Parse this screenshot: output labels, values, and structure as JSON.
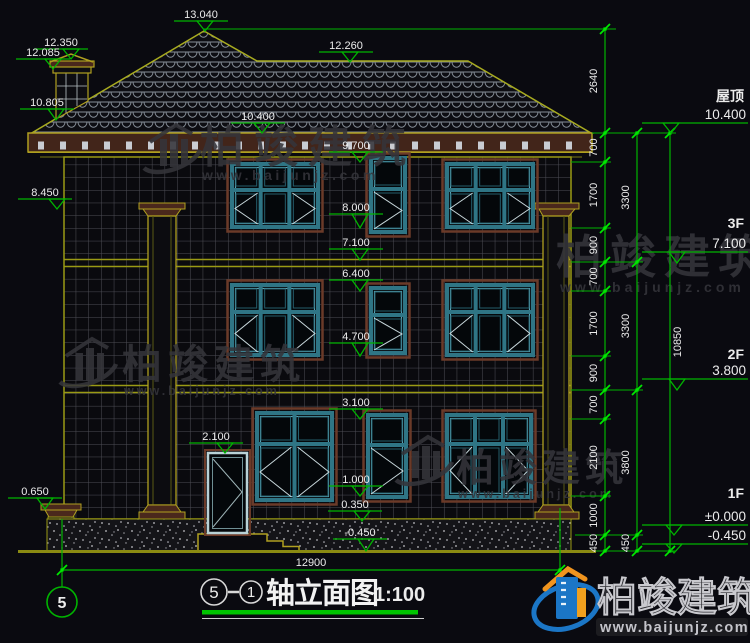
{
  "drawing": {
    "title": {
      "axis_start": "5",
      "axis_end": "1",
      "name": "轴立面图",
      "scale": "1:100"
    },
    "axis_bubble": {
      "label": "5"
    },
    "overall_width_dim": {
      "label": "12900",
      "y": 570,
      "x1": 62,
      "x2": 560,
      "lx": 311,
      "ly": 566
    },
    "levels_right": [
      {
        "name": "屋顶",
        "value": "10.400",
        "ny": 101,
        "vy": 119,
        "ly": 123,
        "ax": 671,
        "ay": 133
      },
      {
        "name": "3F",
        "value": "7.100",
        "ny": 228,
        "vy": 248,
        "ly": 252,
        "ax": 677,
        "ay": 263
      },
      {
        "name": "2F",
        "value": "3.800",
        "ny": 359,
        "vy": 375,
        "ly": 379,
        "ax": 677,
        "ay": 390
      },
      {
        "name": "1F",
        "value": "±0.000",
        "ny": 498,
        "vy": 521,
        "ly": 525,
        "ax": 674,
        "ay": 535
      },
      {
        "name": "",
        "value": "-0.450",
        "ny": 0,
        "vy": 540,
        "ly": 544,
        "ax": 674,
        "ay": 553
      }
    ],
    "levels_mid": [
      {
        "label": "13.040",
        "tx": 201,
        "ty": 18,
        "ax": 205,
        "ay": 31
      },
      {
        "label": "12.260",
        "tx": 346,
        "ty": 49,
        "ax": 350,
        "ay": 62
      },
      {
        "label": "10.400",
        "tx": 258,
        "ty": 120,
        "ax": 262,
        "ay": 133
      },
      {
        "label": "9.700",
        "tx": 356,
        "ty": 149,
        "ax": 360,
        "ay": 162
      },
      {
        "label": "8.000",
        "tx": 356,
        "ty": 211,
        "ax": 360,
        "ay": 228
      },
      {
        "label": "7.100",
        "tx": 356,
        "ty": 246,
        "ax": 360,
        "ay": 260
      },
      {
        "label": "6.400",
        "tx": 356,
        "ty": 277,
        "ax": 360,
        "ay": 291
      },
      {
        "label": "4.700",
        "tx": 356,
        "ty": 340,
        "ax": 360,
        "ay": 356
      },
      {
        "label": "3.100",
        "tx": 356,
        "ty": 406,
        "ax": 360,
        "ay": 419
      },
      {
        "label": "2.100",
        "tx": 216,
        "ty": 440,
        "ax": 225,
        "ay": 453
      },
      {
        "label": "1.000",
        "tx": 356,
        "ty": 483,
        "ax": 360,
        "ay": 496
      },
      {
        "label": "0.350",
        "tx": 355,
        "ty": 508,
        "ax": 362,
        "ay": 521
      },
      {
        "label": "-0.450",
        "tx": 360,
        "ty": 536,
        "ax": 366,
        "ay": 551
      }
    ],
    "levels_left": [
      {
        "label": "12.350",
        "tx": 61,
        "ty": 46,
        "ax": 71,
        "ay": 59
      },
      {
        "label": "12.085",
        "tx": 43,
        "ty": 56,
        "ax": 53,
        "ay": 69
      },
      {
        "label": "10.805",
        "tx": 47,
        "ty": 106,
        "ax": 56,
        "ay": 120
      },
      {
        "label": "8.450",
        "tx": 45,
        "ty": 196,
        "ax": 57,
        "ay": 209
      },
      {
        "label": "0.650",
        "tx": 35,
        "ty": 495,
        "ax": 45,
        "ay": 509
      }
    ],
    "dim_chains": [
      {
        "x": 605,
        "label_x": 597,
        "side": "left",
        "ticks": [
          29,
          133,
          162,
          228,
          262,
          291,
          356,
          390,
          419,
          496,
          535,
          551
        ],
        "labels": [
          "2640",
          "700",
          "1700",
          "900",
          "700",
          "1700",
          "900",
          "700",
          "2100",
          "1000",
          "450"
        ]
      },
      {
        "x": 637,
        "label_x": 629,
        "side": "left",
        "ticks": [
          133,
          262,
          390,
          535,
          551
        ],
        "labels": [
          "3300",
          "3300",
          "3800",
          "450"
        ]
      },
      {
        "x": 670,
        "label_x": 681,
        "side": "right",
        "ticks": [
          133,
          551
        ],
        "labels": [
          "10850"
        ]
      }
    ],
    "extensions": [
      {
        "y": 29,
        "x1": 204,
        "x2": 616
      },
      {
        "y": 133,
        "x1": 592,
        "x2": 676
      },
      {
        "y": 162,
        "x1": 571,
        "x2": 611
      },
      {
        "y": 228,
        "x1": 571,
        "x2": 611
      },
      {
        "y": 262,
        "x1": 571,
        "x2": 643
      },
      {
        "y": 291,
        "x1": 571,
        "x2": 611
      },
      {
        "y": 356,
        "x1": 571,
        "x2": 611
      },
      {
        "y": 390,
        "x1": 571,
        "x2": 643
      },
      {
        "y": 419,
        "x1": 571,
        "x2": 611
      },
      {
        "y": 496,
        "x1": 571,
        "x2": 611
      },
      {
        "y": 535,
        "x1": 575,
        "x2": 643
      },
      {
        "y": 551,
        "x1": 596,
        "x2": 676
      }
    ]
  },
  "watermark": {
    "brand": "柏竣建筑",
    "url": "www.baijunjz.com",
    "stamps": [
      {
        "logo": true,
        "lx": 146,
        "ly": 122,
        "tx": 200,
        "ty": 162,
        "fs": 44,
        "ls": 10,
        "ux": 202,
        "uy": 180,
        "ufs": 14,
        "uls": 3.5
      },
      {
        "logo": false,
        "lx": 0,
        "ly": 0,
        "tx": 556,
        "ty": 273,
        "fs": 46,
        "ls": 8,
        "ux": 560,
        "uy": 292,
        "ufs": 14,
        "uls": 4
      },
      {
        "logo": true,
        "lx": 62,
        "ly": 336,
        "tx": 122,
        "ty": 378,
        "fs": 40,
        "ls": 6,
        "ux": 124,
        "uy": 395,
        "ufs": 12.5,
        "uls": 3
      },
      {
        "logo": true,
        "lx": 398,
        "ly": 434,
        "tx": 456,
        "ty": 481,
        "fs": 38,
        "ls": 5,
        "ux": 458,
        "uy": 498,
        "ufs": 12.5,
        "uls": 3
      }
    ]
  },
  "colors": {
    "background": "#0a0a10",
    "dim_green": "#00b400",
    "tick_green": "#00e800",
    "outline_olive": "#b0a020",
    "trim_maroon": "#6b3a28",
    "band_maroon": "#42251a",
    "window_teal": "#2f7585",
    "window_teal_light": "#5aa5b5",
    "text_white": "#ececec",
    "grid_gray": "#4e4e56",
    "watermark_gray": "#35353b",
    "logo_blue": "#1b76c6",
    "logo_orange": "#f0941e"
  }
}
